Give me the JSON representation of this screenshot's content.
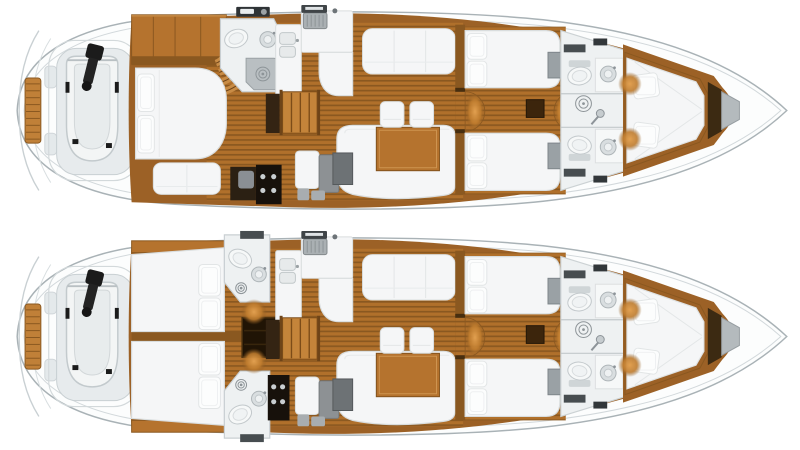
{
  "canvas": {
    "width": 800,
    "height": 450,
    "background": "#ffffff"
  },
  "image": {
    "kind": "yacht-interior-floorplan",
    "views": 2,
    "orientation": "bow-right-stern-left"
  },
  "boats": [
    {
      "id": "boat-top",
      "aft_layout": "owner-master-cabin",
      "features": [
        "swim-platform",
        "tender-garage",
        "dinghy",
        "outboard-motor",
        "aft-master-cabin",
        "island-bed",
        "sofa",
        "vanity-locker",
        "aft-head-shower",
        "companionway-stairs",
        "galley",
        "bottle-locker",
        "salon-settee",
        "salon-table",
        "stools",
        "tv-cabinet",
        "port-settee",
        "guest-cabin-port",
        "guest-cabin-starboard",
        "twin-heads",
        "shared-shower",
        "v-berth",
        "anchor-locker"
      ]
    },
    {
      "id": "boat-bottom",
      "aft_layout": "twin-guest-cabins",
      "features": [
        "swim-platform",
        "tender-garage",
        "dinghy",
        "outboard-motor",
        "aft-cabin-port",
        "aft-cabin-starboard",
        "aft-head-port",
        "aft-head-starboard",
        "engine-room-hatch",
        "companionway-stairs",
        "galley",
        "bottle-locker",
        "salon-settee",
        "salon-table",
        "stools",
        "tv-cabinet",
        "port-settee",
        "guest-cabin-port",
        "guest-cabin-starboard",
        "twin-heads",
        "shared-shower",
        "v-berth",
        "anchor-locker"
      ]
    }
  ],
  "colors": {
    "hull_fill": "#fcfdfd",
    "hull_stroke": "#a9b2b6",
    "hull_inner_line": "#d2d8db",
    "deck_shadow": "#e4e9eb",
    "garage_pad": "#e7ebed",
    "garage_stroke": "#c9d0d3",
    "teak": "#c08038",
    "teak_line": "#8a5820",
    "dinghy_tube": "#f3f5f5",
    "dinghy_stroke": "#c3cacd",
    "dinghy_floor": "#e8eced",
    "motor_black": "#1b1b1b",
    "wood_base": "#9c6126",
    "wood": "#b5732e",
    "wood_light": "#c88c46",
    "wood_dark": "#8a5820",
    "wood_edge": "#6e4418",
    "plank_light": "#b0702b",
    "plank_dark": "#8a5820",
    "furniture_white": "#f5f6f7",
    "furniture_stroke": "#d9ddde",
    "pillow": "#fcfdfd",
    "pillow_stroke": "#e2e5e6",
    "bath_floor": "#eef1f2",
    "bath_stroke": "#c9cfd2",
    "fixture_fill": "#f6f8f8",
    "fixture_stroke": "#c2c8cb",
    "fixture_gray": "#d9dee0",
    "metal_gray": "#aab0b3",
    "dark_door": "#474d50",
    "hatch_dark": "#32373a",
    "locker_dark": "#342413",
    "opening_dark": "#201405",
    "bottle_dark": "#17110b",
    "bottle_glint": "#c9ced1",
    "gray_pad": "#8d9194",
    "wardrobe_gray": "#9aa1a5",
    "tv_gray": "#6d7275",
    "shower_gray": "#b9bfc2",
    "drain_stroke": "#8d9498",
    "glow_center": "#e2a050",
    "glow_mid": "#bf7c2e",
    "anchor_box": "#3c2a12",
    "anchor_tip": "#b4babd",
    "anchor_tip_stroke": "#969da1"
  }
}
